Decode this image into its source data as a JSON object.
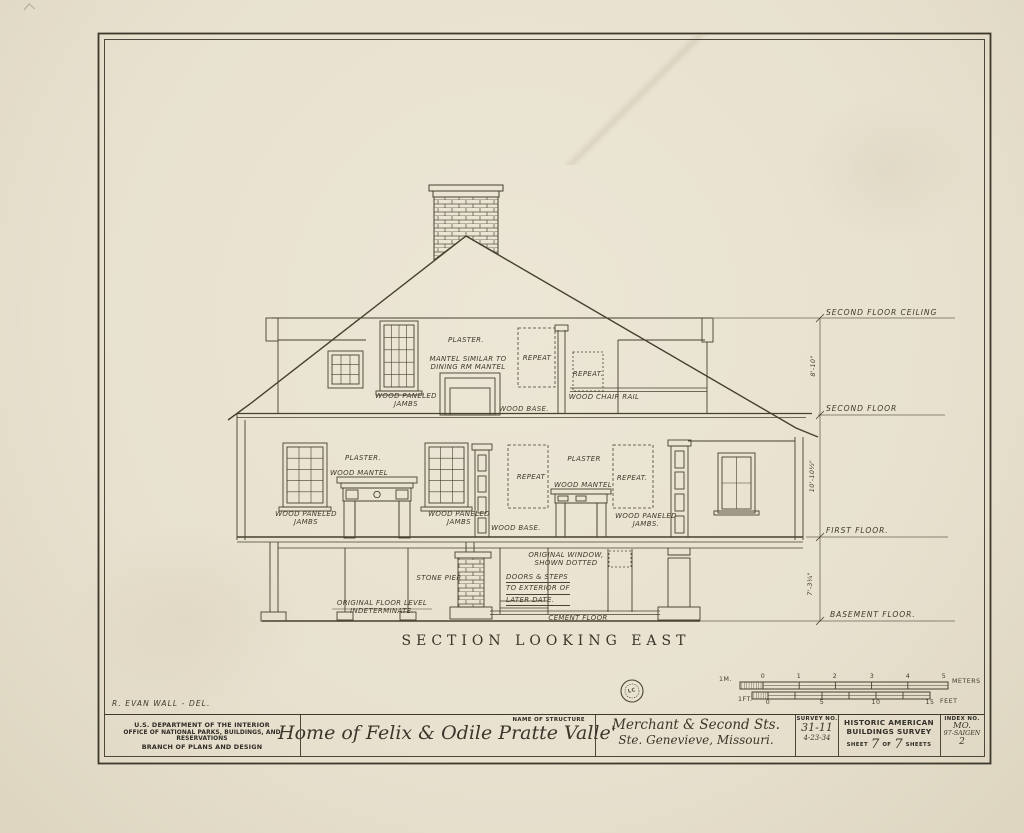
{
  "colors": {
    "paper": "#eae3d1",
    "ink": "#46402f",
    "faint_line": "#6a6456"
  },
  "section": {
    "title": "SECTION LOOKING EAST"
  },
  "annotations": {
    "attic_plaster": "PLASTER.",
    "attic_mantel_note": [
      "MANTEL SIMILAR TO",
      "DINING RM MANTEL"
    ],
    "attic_repeat_left": "REPEAT",
    "attic_repeat_right": "REPEAT.",
    "attic_jambs": [
      "WOOD PANELED",
      "JAMBS"
    ],
    "attic_wood_base": "WOOD BASE.",
    "attic_chair_rail": "WOOD CHAIR RAIL",
    "ff_plaster_left": "PLASTER.",
    "ff_mantel_left": "WOOD MANTEL",
    "ff_jambs_left": [
      "WOOD PANELED",
      "JAMBS"
    ],
    "ff_jambs_mid": [
      "WOOD PANELED",
      "JAMBS"
    ],
    "ff_repeat_left": "REPEAT",
    "ff_plaster_center": "PLASTER",
    "ff_mantel_center": "WOOD MANTEL",
    "ff_repeat_right": "REPEAT.",
    "ff_jambs_right": [
      "WOOD PANELED",
      "JAMBS."
    ],
    "ff_wood_base": "WOOD BASE.",
    "bsmt_stone_pier": "STONE PIER",
    "bsmt_orig_window": [
      "ORIGINAL WINDOW,",
      "SHOWN DOTTED"
    ],
    "bsmt_doors_steps": [
      "DOORS & STEPS",
      "TO EXTERIOR OF",
      "LATER DATE."
    ],
    "bsmt_floor_level": [
      "ORIGINAL FLOOR LEVEL",
      "INDETERMINATE."
    ],
    "bsmt_cement_floor": "CEMENT FLOOR"
  },
  "levels": {
    "second_floor_ceiling": "SECOND FLOOR CEILING",
    "second_floor": "SECOND FLOOR",
    "first_floor": "FIRST FLOOR.",
    "basement_floor": "BASEMENT FLOOR.",
    "dim_ceiling_to_second": "8'-10\"",
    "dim_second_to_first": "10'-10½\"",
    "dim_first_to_basement": "7'-3¼\""
  },
  "scale_bars": {
    "meters": {
      "prefix": "1M.",
      "ticks": [
        "0",
        "1",
        "2",
        "3",
        "4",
        "5"
      ],
      "unit": "METERS"
    },
    "feet": {
      "prefix": "1FT.",
      "ticks": [
        "0",
        "5",
        "10",
        "15"
      ],
      "unit": "FEET"
    }
  },
  "stamp": {
    "text": "LC"
  },
  "credit": {
    "delineator": "R. EVAN WALL - DEL."
  },
  "title_block": {
    "agency_lines": [
      "U.S. DEPARTMENT OF THE INTERIOR",
      "OFFICE OF NATIONAL PARKS, BUILDINGS, AND RESERVATIONS",
      "BRANCH OF PLANS AND DESIGN"
    ],
    "name_label": "NAME OF STRUCTURE",
    "structure_name": "Home of Felix & Odile Pratte Valle'",
    "address_lines": [
      "Merchant & Second Sts.",
      "Ste. Genevieve, Missouri."
    ],
    "survey_label": "SURVEY NO.",
    "survey_no": "31-11",
    "survey_date": "4-23-34",
    "habs_lines": [
      "HISTORIC AMERICAN",
      "BUILDINGS SURVEY"
    ],
    "sheet_prefix": "SHEET",
    "sheet_no": "7",
    "sheet_of": "OF",
    "sheet_total": "7",
    "sheet_suffix": "SHEETS",
    "index_label": "INDEX NO.",
    "index_lines": [
      "MO.",
      "97-SAIGEN",
      "2"
    ]
  }
}
